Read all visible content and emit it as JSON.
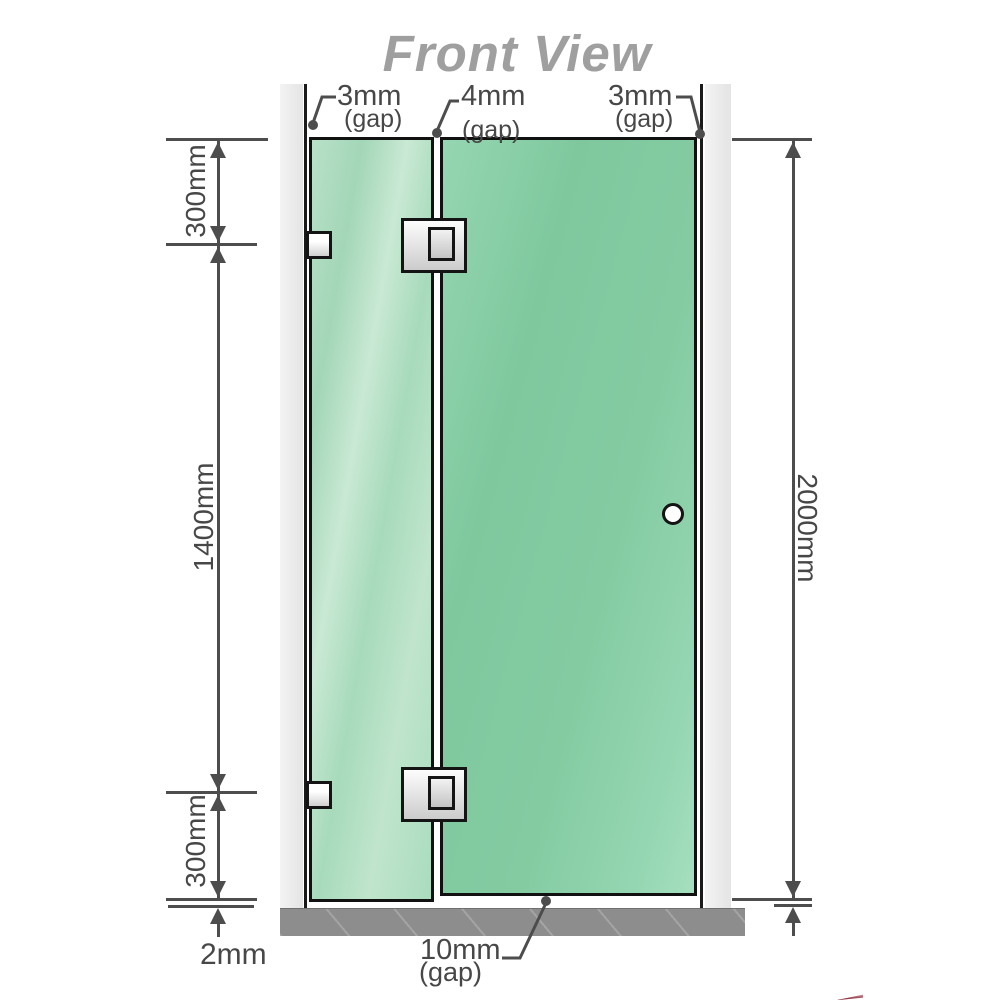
{
  "title": "Front View",
  "gaps": {
    "left": {
      "value": "3mm",
      "caption": "(gap)"
    },
    "middle": {
      "value": "4mm",
      "caption": "(gap)"
    },
    "right": {
      "value": "3mm",
      "caption": "(gap)"
    },
    "bottom": {
      "value": "10mm",
      "caption": "(gap)"
    }
  },
  "dimensions": {
    "left_top": "300mm",
    "left_middle": "1400mm",
    "left_bottom": "300mm",
    "right_total": "2000mm",
    "floor_clearance": "2mm"
  },
  "colors": {
    "line": "#4d4d4d",
    "text": "#474747",
    "title": "#9f9f9f",
    "wall": "#ececec",
    "wall_edge": "#1a1a1a",
    "glass_border": "#111111",
    "glass_fixed": "#a9dabd",
    "glass_door": "#84cba3",
    "floor": "#8d8d8d",
    "accent_red": "#7c1326"
  }
}
